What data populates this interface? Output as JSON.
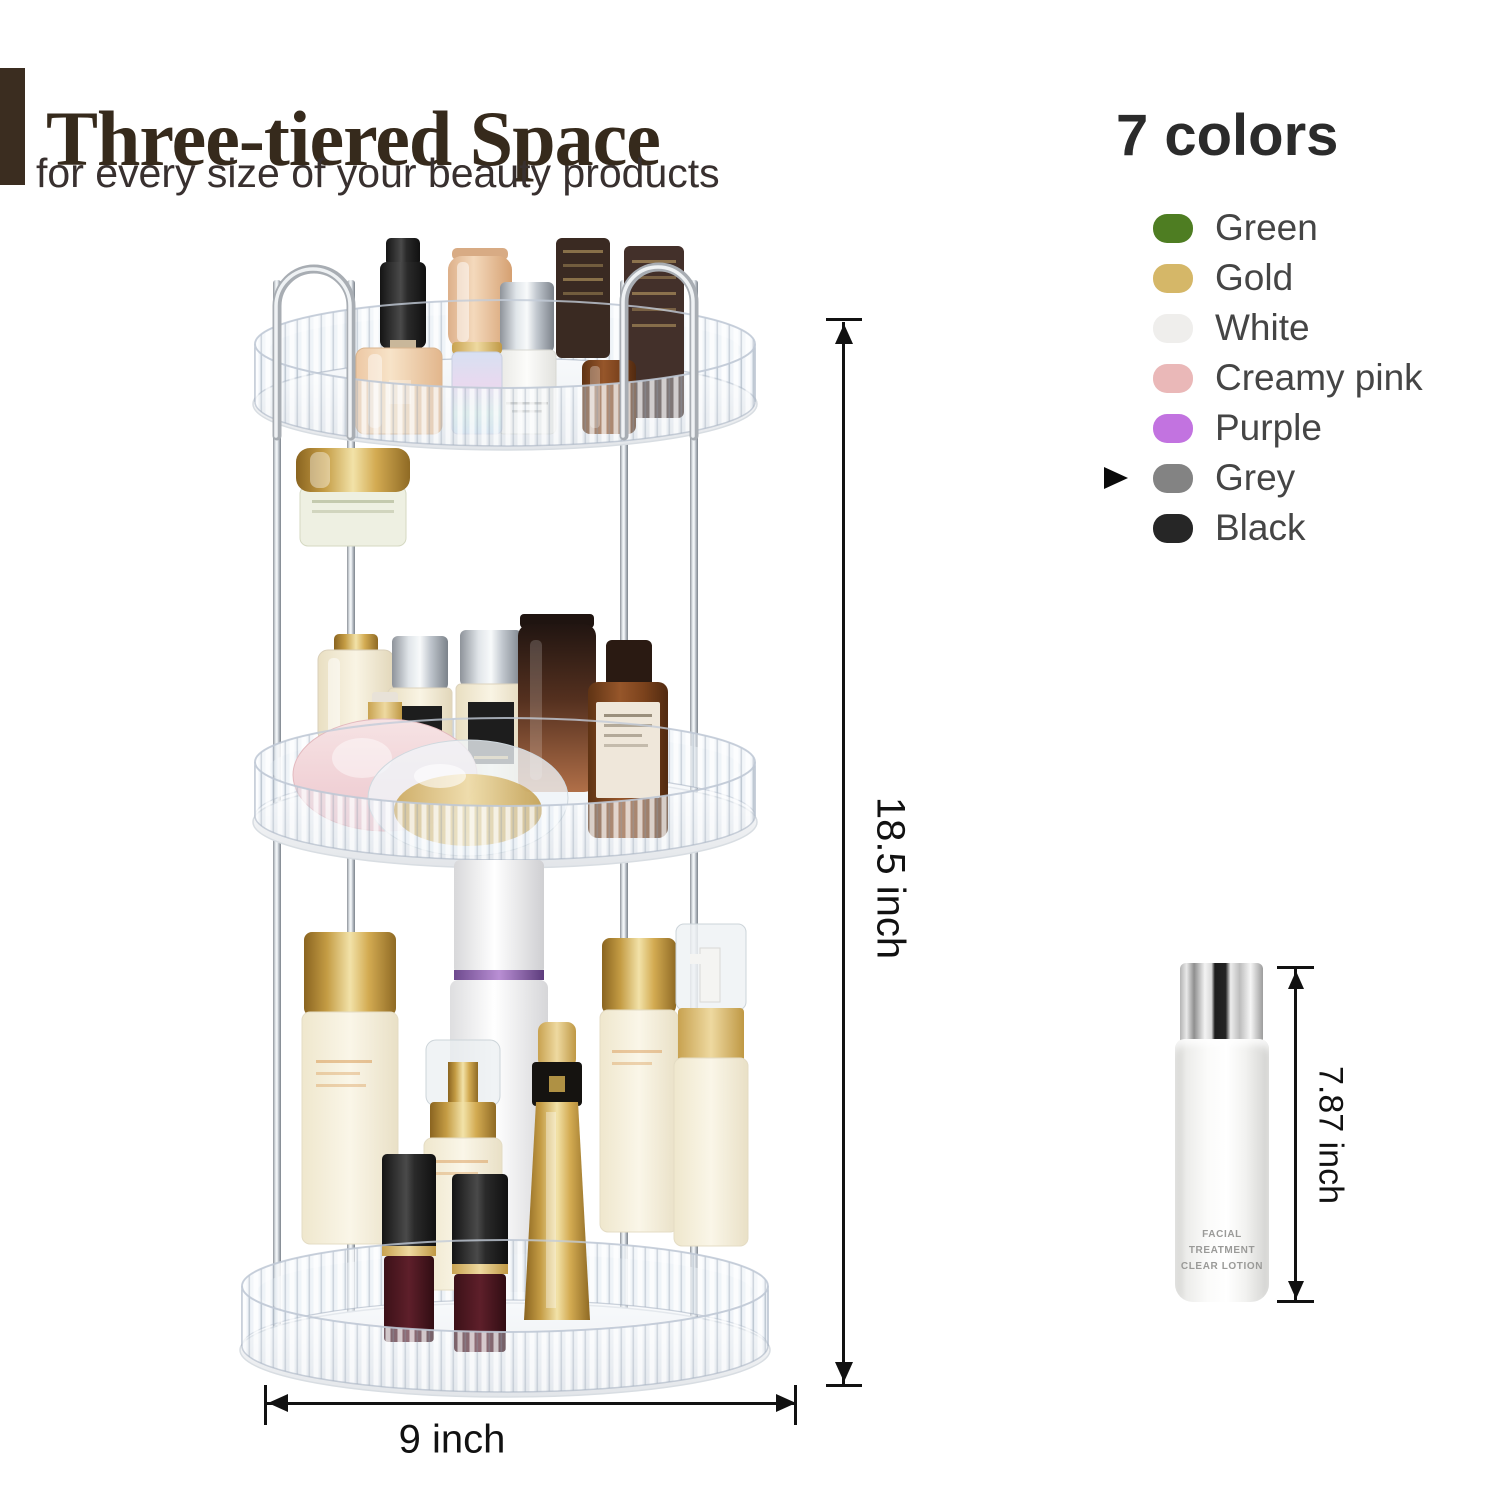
{
  "header": {
    "title": "Three-tiered Space",
    "subtitle": "for every size of your beauty products",
    "accent_bar_color": "#3b2d20",
    "title_color": "#362a1c"
  },
  "colors_panel": {
    "heading": "7 colors",
    "selected_label": "Grey",
    "items": [
      {
        "label": "Green",
        "hex": "#4e7d22"
      },
      {
        "label": "Gold",
        "hex": "#d5b768"
      },
      {
        "label": "White",
        "hex": "#efeeec"
      },
      {
        "label": "Creamy pink",
        "hex": "#eab8b8"
      },
      {
        "label": "Purple",
        "hex": "#c273e0"
      },
      {
        "label": "Grey",
        "hex": "#838383"
      },
      {
        "label": "Black",
        "hex": "#262626"
      }
    ]
  },
  "dimensions": {
    "height_label": "18.5 inch",
    "width_label": "9 inch",
    "bottle_height_label": "7.87 inch"
  },
  "reference_bottle": {
    "label_line1": "FACIAL TREATMENT",
    "label_line2": "CLEAR LOTION"
  }
}
